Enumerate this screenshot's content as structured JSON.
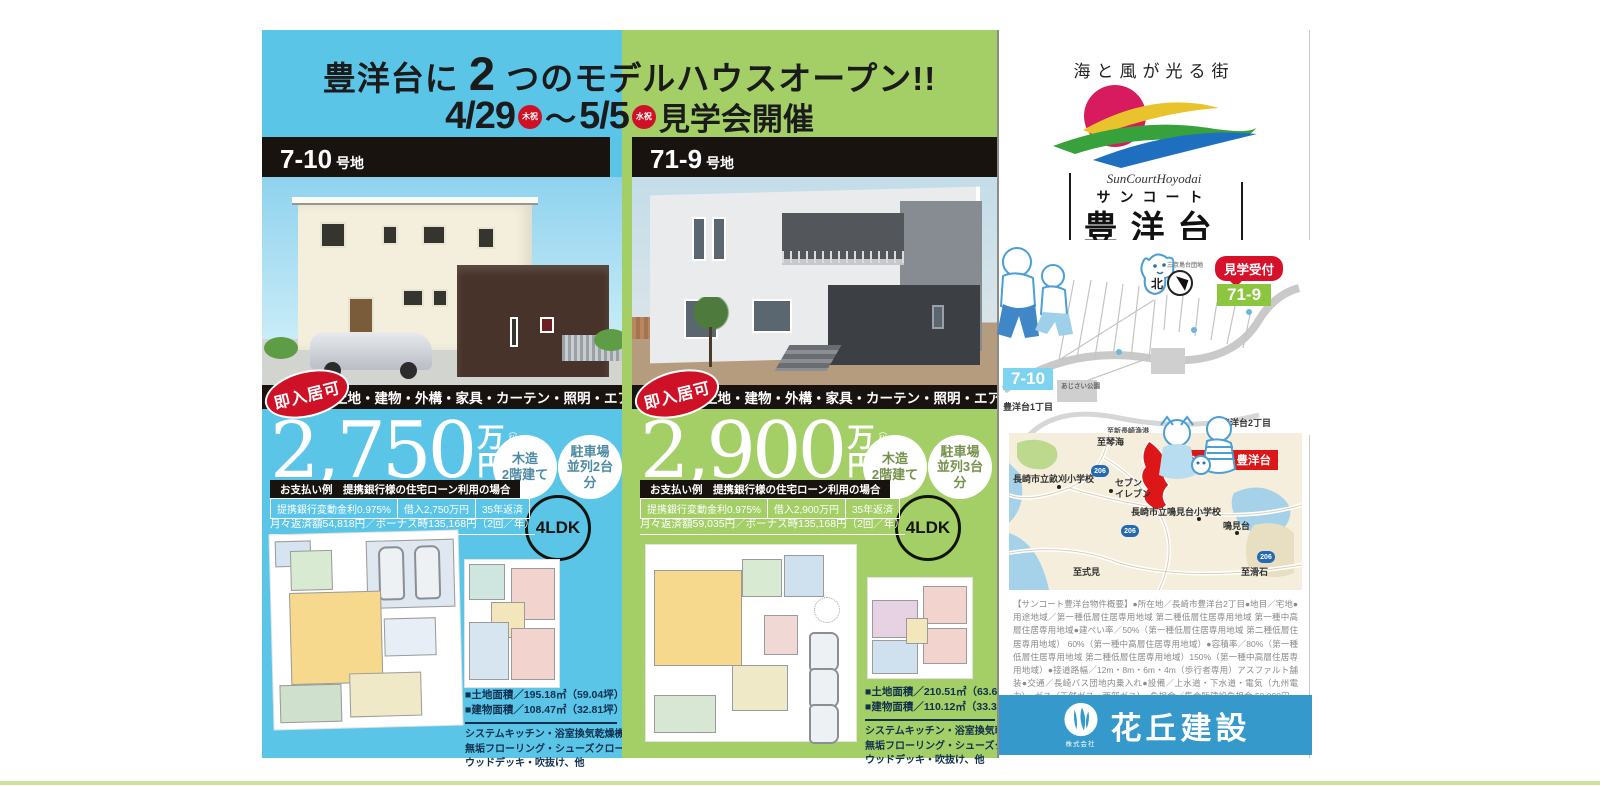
{
  "header": {
    "title_pre": "豊洋台に",
    "title_num": "2",
    "title_post": "つのモデルハウスオープン!!",
    "date_from": "4/29",
    "holiday_badge_1": "木祝",
    "tilde": "〜",
    "date_to": "5/5",
    "holiday_badge_2": "水祝",
    "event": "見学会開催"
  },
  "panels": [
    {
      "lot_number": "7-10",
      "lot_suffix": "号地",
      "move_in_badge": "即入居可",
      "included_items": "土地・建物・外構・家具・カーテン・照明・エアコン含む",
      "price": "2,750",
      "unit_man": "万",
      "unit_yen": "円",
      "tax_note": "（税込）",
      "structure_line1": "木造",
      "structure_line2": "2階建て",
      "parking_line1": "駐車場",
      "parking_line2": "並列2台",
      "parking_line3": "分",
      "layout": "4LDK",
      "payment_title": "お支払い例　提携銀行様の住宅ローン利用の場合",
      "payment_rate": "提携銀行変動金利0.975%",
      "payment_loan": "借入2,750万円",
      "payment_term": "35年返済",
      "payment_monthly": "月々返済額54,818円／ボーナス時135,168円（2回／年）",
      "land_area": "■土地面積／195.18㎡（59.04坪）",
      "building_area": "■建物面積／108.47㎡（32.81坪）",
      "features": [
        "システムキッチン・浴室換気乾燥機",
        "無垢フローリング・シューズクローゼット",
        "ウッドデッキ・吹抜け、他"
      ]
    },
    {
      "lot_number": "71-9",
      "lot_suffix": "号地",
      "move_in_badge": "即入居可",
      "included_items": "土地・建物・外構・家具・カーテン・照明・エアコン含む",
      "price": "2,900",
      "unit_man": "万",
      "unit_yen": "円",
      "tax_note": "（税込）",
      "structure_line1": "木造",
      "structure_line2": "2階建て",
      "parking_line1": "駐車場",
      "parking_line2": "並列3台",
      "parking_line3": "分",
      "layout": "4LDK",
      "payment_title": "お支払い例　提携銀行様の住宅ローン利用の場合",
      "payment_rate": "提携銀行変動金利0.975%",
      "payment_loan": "借入2,900万円",
      "payment_term": "35年返済",
      "payment_monthly": "月々返済額59,035円／ボーナス時135,168円（2回／年）",
      "land_area": "■土地面積／210.51㎡（63.67坪）",
      "building_area": "■建物面積／110.12㎡（33.31坪）",
      "features": [
        "システムキッチン・浴室換気乾燥機",
        "無垢フローリング・シューズクローゼット",
        "ウッドデッキ・吹抜け、他"
      ]
    }
  ],
  "brand": {
    "tagline": "海と風が光る街",
    "logo_script": "SunCourtHoyodai",
    "logo_kana": "サンコート",
    "logo_kanji": "豊洋台"
  },
  "site_map": {
    "reception_badge": "見学受付",
    "lot_71_9": "71-9",
    "lot_7_10": "7-10",
    "north": "北",
    "district_label": "三京島台団地",
    "chome2": "豊洋台2丁目",
    "chome1": "豊洋台1丁目",
    "park": "あじさい公園",
    "road_south": "至新長崎漁港"
  },
  "area_map": {
    "to_kinkai": "至琴海",
    "site_label": "サンコート豊洋台",
    "school_ukari": "長崎市立畝刈小学校",
    "conv_line1": "セブン",
    "conv_line2": "イレブン",
    "school_narumidai": "長崎市立鳴見台小学校",
    "narumidai": "鳴見台",
    "to_shikimi": "至式見",
    "to_nameshi": "至滑石",
    "route_number": "206"
  },
  "legal": {
    "property_overview": "【サンコート豊洋台物件概要】●所在地／長崎市豊洋台2丁目●地目／宅地●用途地域／第一種低層住居専用地域 第二種低層住居専用地域 第一種中高層住居専用地域●建ぺい率／50%（第一種低層住居専用地域 第二種低層住居専用地域） 60%（第一種中高層住居専用地域）●容積率／80%（第一種低層住居専用地域 第二種低層住居専用地域）150%（第一種中高層住居専用地域）●接道路幅／12m・8m・6m・4m（歩行者専用）アスファルト舗装●交通／長崎バス団地内乗入れ●設備／上水道・下水道・電気（九州電力）・ガス（天然ガス—西部ガス）●負担金／集会所建設負担金 50,000円、CATV加入金●取引態様／売主●取引条件有効期限／2021年6月30日"
  },
  "company": {
    "type": "株式会社",
    "name": "花丘建設"
  },
  "colors": {
    "panel_blue": "#5bc5e8",
    "panel_green": "#a3cf66",
    "accent_red": "#ce1126",
    "footer_blue": "#3599cb",
    "logo_sun": "#d81b5e",
    "wave_yellow": "#e9c32b",
    "wave_green": "#37a13c",
    "wave_blue": "#1f6fc0",
    "map_site_red": "#dd1717"
  }
}
